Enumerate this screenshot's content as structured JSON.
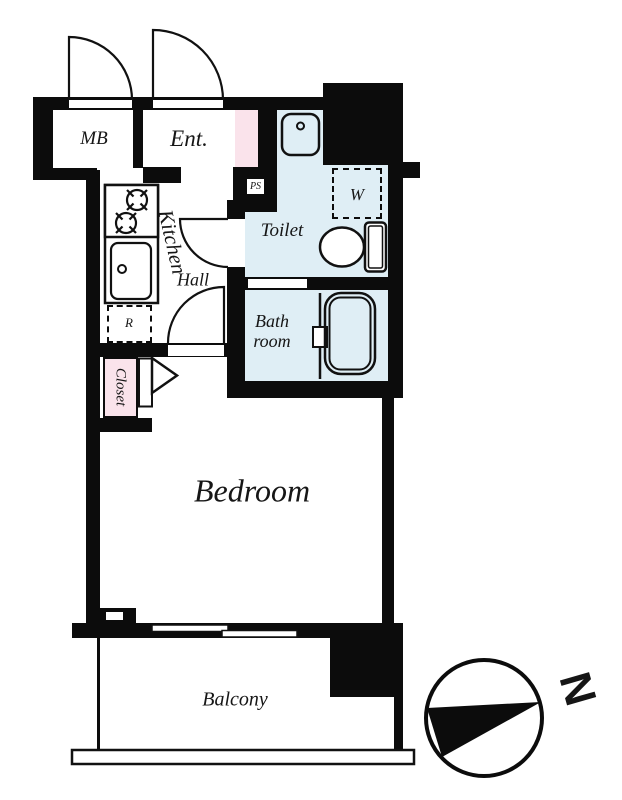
{
  "plan": {
    "rooms": {
      "mb": {
        "label": "MB"
      },
      "entrance": {
        "label": "Ent."
      },
      "ps": {
        "label": "PS"
      },
      "washer": {
        "label": "W"
      },
      "toilet": {
        "label": "Toilet"
      },
      "bathroom": {
        "label": "Bath room"
      },
      "kitchen": {
        "label": "Kitchen"
      },
      "hall": {
        "label": "Hall"
      },
      "fridge": {
        "label": "R"
      },
      "closet": {
        "label": "Closet"
      },
      "bedroom": {
        "label": "Bedroom"
      },
      "balcony": {
        "label": "Balcony"
      }
    },
    "compass": {
      "label": "N"
    },
    "colors": {
      "wall": "#0c0c0c",
      "wet_area": "#dfeef5",
      "accent_pink": "#fae3eb",
      "line": "#111111"
    },
    "icons": [
      "gas-stove-icon",
      "kitchen-sink-icon",
      "wash-basin-icon",
      "toilet-fixture-icon",
      "bathtub-icon",
      "door-swing-icon",
      "bifold-door-icon",
      "sliding-window-icon",
      "compass-icon"
    ]
  }
}
